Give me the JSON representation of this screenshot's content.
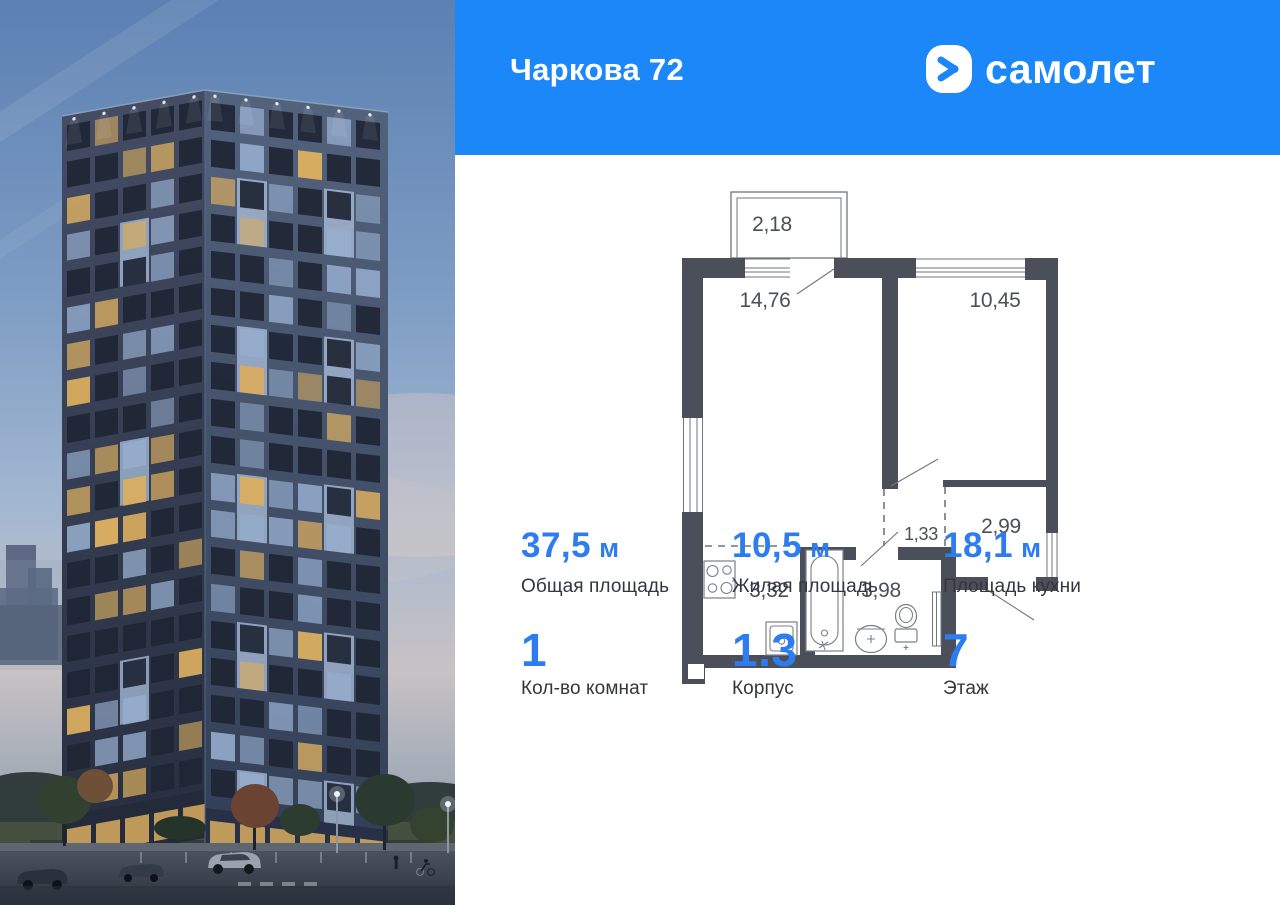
{
  "header": {
    "project_title": "Чаркова 72",
    "brand": "самолет",
    "logo_icon": "samolet-arrow-icon"
  },
  "colors": {
    "header_bg": "#1b87f8",
    "value_blue": "#2d7cf0",
    "text_dark": "#33363e",
    "plan_wall": "#4b4f5a",
    "plan_line": "#71757f",
    "plan_label": "#4b4f59"
  },
  "floor_plan": {
    "rooms": [
      {
        "id": "balcony",
        "area": "2,18"
      },
      {
        "id": "living-room",
        "area": "14,76"
      },
      {
        "id": "bedroom",
        "area": "10,45"
      },
      {
        "id": "hall",
        "area": "1,33"
      },
      {
        "id": "entry-hall",
        "area": "2,99"
      },
      {
        "id": "kitchen",
        "area": "3,32"
      },
      {
        "id": "bathroom",
        "area": "3,98"
      }
    ]
  },
  "stats": {
    "row1": [
      {
        "value": "37,5",
        "unit": "м",
        "label": "Общая площадь"
      },
      {
        "value": "10,5",
        "unit": "м",
        "label": "Жилая площадь"
      },
      {
        "value": "18,1",
        "unit": "м",
        "label": "Площадь кухни"
      }
    ],
    "row2": [
      {
        "value": "1",
        "unit": "",
        "label": "Кол-во комнат"
      },
      {
        "value": "1.3",
        "unit": "",
        "label": "Корпус"
      },
      {
        "value": "7",
        "unit": "",
        "label": "Этаж"
      }
    ]
  },
  "photo": {
    "sky_top": "#5b80b2",
    "sky_mid": "#9db3cf",
    "sky_haze": "#c8c2c4",
    "facade_left_top": "#434c63",
    "facade_left_bottom": "#272e40",
    "facade_right_top": "#53627c",
    "facade_right_bottom": "#323e55",
    "window_dark": "#1e2635",
    "window_glass": "#96aecf",
    "window_lit": "#d9ad60",
    "floors": 19
  }
}
